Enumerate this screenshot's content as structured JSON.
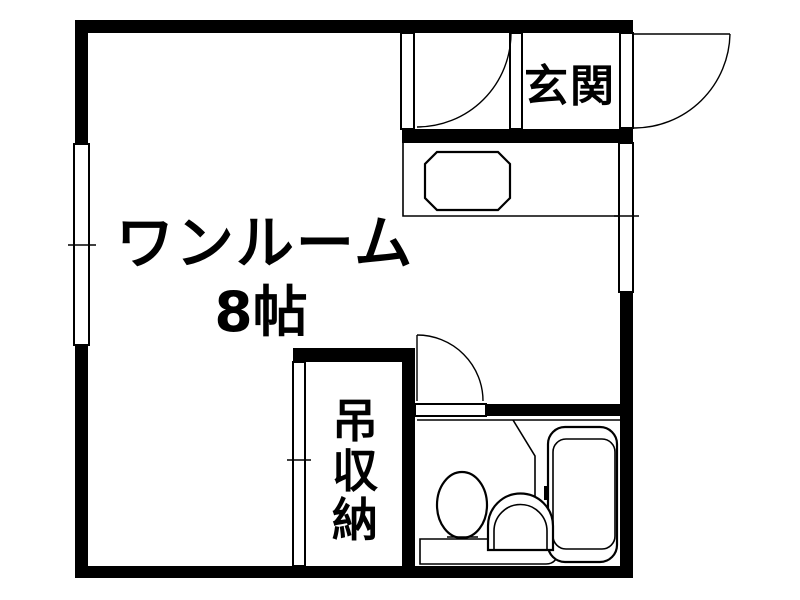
{
  "colors": {
    "background": "#ffffff",
    "line": "#000000"
  },
  "floorplan": {
    "main_room": {
      "name": "ワンルーム",
      "size": "8帖"
    },
    "entrance": {
      "label": "玄関"
    },
    "storage": {
      "label": "吊収納",
      "chars": [
        "吊",
        "収",
        "納"
      ]
    }
  }
}
